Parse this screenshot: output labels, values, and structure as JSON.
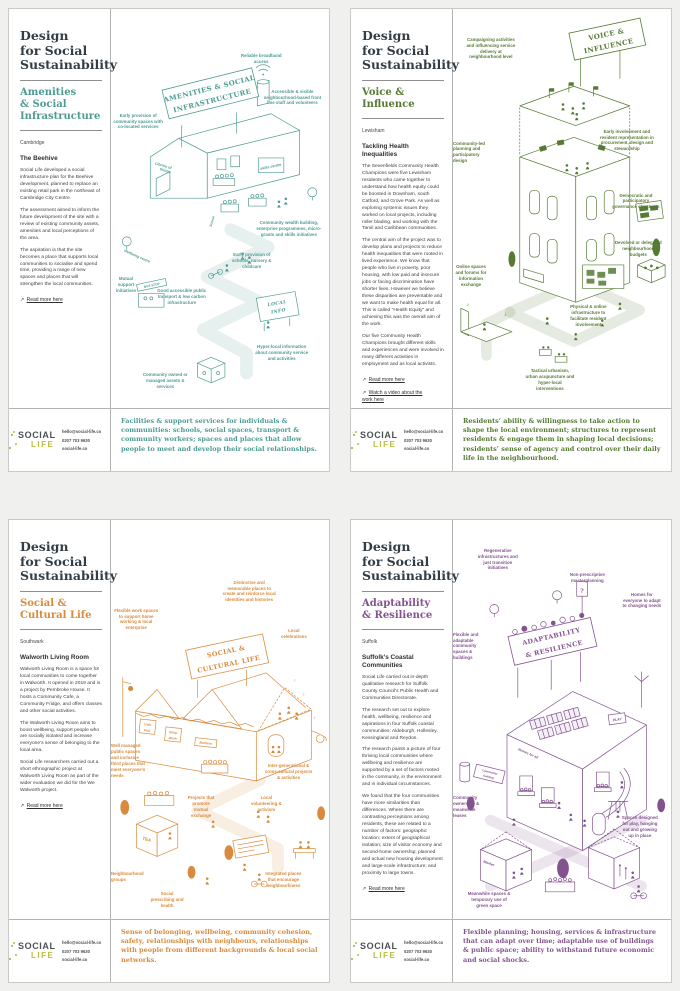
{
  "brand": {
    "title": "Design\nfor Social\nSustainability",
    "logo_line1": "SOCIAL",
    "logo_line2": "LIFE",
    "logo_color_dark": "#4d5257",
    "logo_color_lime": "#b9bd3b"
  },
  "contact": {
    "email": "hello@social-life.co",
    "phone": "0207 703 9630",
    "website": "social-life.co"
  },
  "posters": [
    {
      "name": "amenities-social-infrastructure",
      "accent": "#4E9B93",
      "subtitle": "Amenities\n& Social\nInfrastructure",
      "location": "Cambridge",
      "heading": "The Beehive",
      "paragraphs": [
        "Social Life developed a social infrastructure plan for the Beehive development, planned to replace an existing retail park in the northeast of Cambridge City Centre.",
        "The assessment aimed to inform the future development of the site with a review of existing community assets, amenities and local perceptions of the area.",
        "The aspiration is that the site becomes a place that supports local communities to socialise and spend time, providing a range of new spaces and places that will strengthen the local communities."
      ],
      "links": [
        "Read more here"
      ],
      "summary": "Facilities & support services for individuals & communities: schools, social spaces, transport & community workers; spaces and places that allow people to meet and develop their social relationships.",
      "sign1": "AMENITIES & SOCIAL",
      "sign2": "INFRASTRUCTURE",
      "micro": {
        "library1": "Library of",
        "library2": "things",
        "skills": "skills centre",
        "school": "School",
        "wellbeing": "Wellbeing centre",
        "busstop": "BUS STOP",
        "local1": "LOCAL",
        "local2": "INFO"
      },
      "callouts": [
        {
          "t": "Reliable broadband access",
          "x": 57,
          "y": 11,
          "w": 52
        },
        {
          "t": "Accessible & visible neighbourhood-based front line staff and volunteers",
          "x": 69,
          "y": 20,
          "w": 62
        },
        {
          "t": "Early provision of community spaces with co-located services",
          "x": 1,
          "y": 26,
          "w": 50
        },
        {
          "t": "Community wealth building, enterprise programmes, micro-grants and skills initiatives",
          "x": 66,
          "y": 53,
          "w": 68
        },
        {
          "t": "Early provision of schools, nursery & childcare",
          "x": 54,
          "y": 61,
          "w": 46
        },
        {
          "t": "Mutual support initiatives",
          "x": 0,
          "y": 67,
          "w": 30
        },
        {
          "t": "Good accessible public transport & low carbon infrastructure",
          "x": 21,
          "y": 70,
          "w": 50
        },
        {
          "t": "Hyper-local information about community service and activities",
          "x": 65,
          "y": 84,
          "w": 58
        },
        {
          "t": "Community owned or managed assets & services",
          "x": 13,
          "y": 91,
          "w": 52
        }
      ]
    },
    {
      "name": "voice-influence",
      "accent": "#567A34",
      "subtitle": "Voice &\nInfluence",
      "location": "Lewisham",
      "heading": "Tackling Health\nInequalities",
      "paragraphs": [
        "The Sevenfields Community Health Champions were five Lewisham residents who came together to understand how health equity could be boosted in Downham, south Catford, and Grove Park. As well as exploring systemic issues they worked on local projects, including roller blading, and working with the Tamil and Caribbean communities.",
        "The central aim of the project was to develop plans and projects to reduce health inequalities that were rooted in lived experience. We know that people who live in poverty, poor housing, with low paid and insecure jobs or facing discrimination have shorter lives. However we believe these disparities are preventable and we want to make health equal for all. This is called \"Health Equity\" and achieving this was the overall aim of the work.",
        "Our five Community Health Champions brought different skills and experiences and were involved in many different activities in employment and as local activists."
      ],
      "links": [
        "Read more here",
        "Watch a video about the work here"
      ],
      "summary": "Residents’ ability & willingness to take action to shape the local environment; structures to represent residents & engage them in shaping local decisions; residents’ sense of agency and control over their daily life in the neighbourhood.",
      "sign1": "VOICE &",
      "sign2": "INFLUENCE",
      "micro": {},
      "callouts": [
        {
          "t": "Campaigning activities and influencing service delivery at neighbourhood level",
          "x": 5,
          "y": 7,
          "w": 54
        },
        {
          "t": "Early involvement and resident representation in procurement, design and stewardship",
          "x": 66,
          "y": 30,
          "w": 60
        },
        {
          "t": "Community-led planning and participatory design",
          "x": 0,
          "y": 33,
          "w": 34,
          "ta": "left"
        },
        {
          "t": "Democratic and participatory governance structures",
          "x": 72,
          "y": 46,
          "w": 52
        },
        {
          "t": "Devolved or delegated neighbourhood budgets",
          "x": 74,
          "y": 58,
          "w": 48
        },
        {
          "t": "Online spaces and forums for information exchange",
          "x": 0,
          "y": 64,
          "w": 36
        },
        {
          "t": "Physical & online infrastructure to facilitate resident involvement",
          "x": 52,
          "y": 74,
          "w": 44
        },
        {
          "t": "Tactical urbanism, urban acupuncture and hyper-local interventions",
          "x": 33,
          "y": 90,
          "w": 50
        }
      ]
    },
    {
      "name": "social-cultural-life",
      "accent": "#D98A3C",
      "subtitle": "Social &\nCultural Life",
      "location": "Southwark",
      "heading": "Walworth Living Room",
      "paragraphs": [
        "Walworth Living Room is a space for local communities to come together in Walworth. It opened in 2019 and is a project by Pembroke House. It hosts a Community Cafe, a Community Fridge, and offers classes and other social activities.",
        "The Walworth Living Room aims to boost wellbeing, support people who are socially isolated and increase everyone’s sense of belonging to the local area.",
        "Social Life researchers carried out a short ethnographic project at Walworth Living Room as part of the wider evaluation we did for the We Walworth project."
      ],
      "links": [
        "Read more here"
      ],
      "summary": "Sense of belonging, wellbeing, community cohesion, safety, relationships with neighbours, relationships with people from different backgrounds & local social networks.",
      "sign1": "SOCIAL &",
      "sign2": "CULTURAL LIFE",
      "micro": {
        "cafe": "Cafe",
        "pub": "Pub",
        "shop": "Shop",
        "work": "Work",
        "barbers": "Barbers",
        "tea": "TEA"
      },
      "callouts": [
        {
          "t": "Flexible work spaces to support home working & local enterprise",
          "x": 1,
          "y": 22,
          "w": 46
        },
        {
          "t": "Distinctive and memorable places to create and reinforce local identities and histories",
          "x": 51,
          "y": 15,
          "w": 54
        },
        {
          "t": "Local celebrations",
          "x": 77,
          "y": 27,
          "w": 30
        },
        {
          "t": "Well managed public spaces and inclusive third places that meet everyone’s needs",
          "x": 0,
          "y": 56,
          "w": 38,
          "ta": "left"
        },
        {
          "t": "Inter-generational & cross-cultural projects & activities",
          "x": 70,
          "y": 61,
          "w": 50
        },
        {
          "t": "Projects that promote mutual exchange",
          "x": 34,
          "y": 69,
          "w": 32
        },
        {
          "t": "Local volunteering & activism",
          "x": 63,
          "y": 69,
          "w": 36
        },
        {
          "t": "Neighbourhood groups",
          "x": 0,
          "y": 88,
          "w": 26,
          "ta": "left"
        },
        {
          "t": "Social prescribing and health",
          "x": 17,
          "y": 93,
          "w": 38
        },
        {
          "t": "Integrated places that encourage neighbourliness",
          "x": 69,
          "y": 88,
          "w": 44
        }
      ]
    },
    {
      "name": "adaptability-resilience",
      "accent": "#83538F",
      "subtitle": "Adaptability\n& Resilience",
      "location": "Suffolk",
      "heading": "Suffolk’s Coastal\nCommunities",
      "paragraphs": [
        "Social Life carried out in-depth qualitative research for Suffolk County Council’s Public Health and Communities Directorate.",
        "The research set out to explore health, wellbeing, resilience and aspirations in four Suffolk coastal communities: Aldeburgh, Hollesley, Kessingland and Reydon.",
        "The research paints a picture of four thriving local communities where wellbeing and resilience are supported by a set of factors rooted in the community, in the environment and in individual circumstances.",
        "We found that the four communities have more similarities than differences. Where there are contrasting perceptions among residents, these are related to a number of factors: geographic location; extent of geographical isolation; size of visitor economy and second-home ownership; planned and actual new housing development and large-scale infrastructure; and proximity to large towns."
      ],
      "links": [
        "Read more here"
      ],
      "summary": "Flexible planning; housing, services & infrastructure that can adapt over time; adaptable use of buildings & public space; ability to withstand future economic and social shocks.",
      "sign1": "ADAPTABILITY",
      "sign2": "& RESILIENCE",
      "micro": {
        "homes": "Homes for all",
        "play": "PLAY",
        "market": "Market",
        "community1": "Community",
        "community2": "building",
        "question": "?"
      },
      "callouts": [
        {
          "t": "Regenerative infrastructures and just transition initiatives",
          "x": 10,
          "y": 7,
          "w": 46
        },
        {
          "t": "Non-prescriptive masterplanning",
          "x": 52,
          "y": 13,
          "w": 42
        },
        {
          "t": "Homes for everyone to adapt to changing needs",
          "x": 77,
          "y": 18,
          "w": 42
        },
        {
          "t": "Flexible and adaptable community spaces & buildings",
          "x": 0,
          "y": 28,
          "w": 30,
          "ta": "left"
        },
        {
          "t": "Community ownership & meanwhile leases",
          "x": 0,
          "y": 69,
          "w": 30,
          "ta": "left"
        },
        {
          "t": "Spaces designed for play, hanging out and growing up in place",
          "x": 77,
          "y": 74,
          "w": 38
        },
        {
          "t": "Meanwhile spaces & temporary use of green space",
          "x": 6,
          "y": 93,
          "w": 46
        }
      ]
    }
  ]
}
